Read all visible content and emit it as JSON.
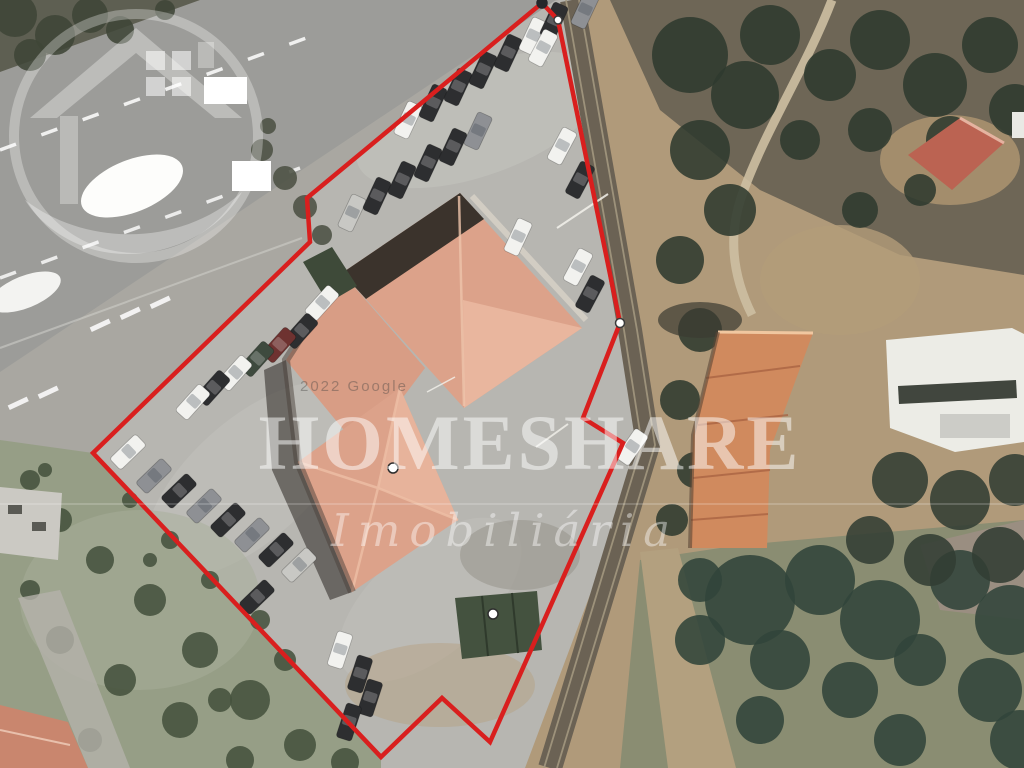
{
  "meta": {
    "description": "Aerial satellite photo of a property with red boundary outline"
  },
  "watermark": {
    "brand": "HOMESHARE",
    "tagline": "Imobiliária",
    "attribution": "2022 Google",
    "text_color": "#ffffff"
  },
  "boundary": {
    "color": "#d91f1e",
    "stroke_width": 4.5,
    "vertices": [
      [
        542,
        3
      ],
      [
        558,
        20
      ],
      [
        620,
        323
      ],
      [
        583,
        418
      ],
      [
        623,
        443
      ],
      [
        490,
        742
      ],
      [
        442,
        698
      ],
      [
        381,
        757
      ],
      [
        93,
        453
      ],
      [
        310,
        242
      ],
      [
        307,
        198
      ]
    ],
    "markers": [
      {
        "x": 542,
        "y": 3,
        "r": 5,
        "fill": "#26262a",
        "ring": "#26262a"
      },
      {
        "x": 558,
        "y": 20,
        "r": 4,
        "fill": "#ffffff",
        "ring": "#3c3c3c"
      },
      {
        "x": 620,
        "y": 323,
        "r": 4.5,
        "fill": "#ffffff",
        "ring": "#3c3c3c"
      },
      {
        "x": 393,
        "y": 468,
        "r": 5,
        "fill": "#ffffff",
        "ring": "#2e2e2e"
      },
      {
        "x": 493,
        "y": 614,
        "r": 5,
        "fill": "#ffffff",
        "ring": "#2e2e2e"
      }
    ]
  },
  "scene": {
    "palette": {
      "parking": "#b7b6b1",
      "road": "#9c9c99",
      "median": "#a9a7a1",
      "field": "#969e86",
      "dirt_tan": "#b09a7a",
      "terrain_brown": "#6e6656",
      "rail_band": "#6b6254",
      "roof_main": "#dca28a",
      "roof_main_light": "#e9b69e",
      "roof_shadow": "#3b332c",
      "roof_right": "#d08a5e",
      "green_canopy": "#3e4a39",
      "bottom_green": "#8a8d72",
      "marking_white": "#ffffff"
    },
    "cars": [
      [
        408,
        120,
        -65,
        "#f2f2ef"
      ],
      [
        433,
        103,
        -65,
        "#2d2e30"
      ],
      [
        458,
        87,
        -65,
        "#2d2e30"
      ],
      [
        483,
        70,
        -65,
        "#2d2e30"
      ],
      [
        508,
        53,
        -65,
        "#2d2e30"
      ],
      [
        533,
        36,
        -65,
        "#f2f2ef"
      ],
      [
        554,
        21,
        -65,
        "#2d2e30"
      ],
      [
        352,
        213,
        -65,
        "#c8c8c4"
      ],
      [
        377,
        196,
        -65,
        "#2d2e30"
      ],
      [
        402,
        180,
        -65,
        "#2d2e30"
      ],
      [
        428,
        163,
        -65,
        "#2d2e30"
      ],
      [
        453,
        147,
        -65,
        "#2d2e30"
      ],
      [
        478,
        131,
        -65,
        "#8e9094"
      ],
      [
        518,
        237,
        -65,
        "#f2f2ef"
      ],
      [
        543,
        48,
        -62,
        "#f2f2ef"
      ],
      [
        562,
        146,
        -62,
        "#f2f2ef"
      ],
      [
        580,
        180,
        -62,
        "#2d2e30"
      ],
      [
        578,
        267,
        -62,
        "#f2f2ef"
      ],
      [
        590,
        294,
        -62,
        "#2d2e30"
      ],
      [
        322,
        303,
        -48,
        "#f2f2ef"
      ],
      [
        301,
        331,
        -48,
        "#2d2e30"
      ],
      [
        279,
        345,
        -48,
        "#6e3230"
      ],
      [
        257,
        359,
        -48,
        "#3e4a3e"
      ],
      [
        235,
        373,
        -48,
        "#f2f2ef"
      ],
      [
        213,
        388,
        -48,
        "#2d2e30"
      ],
      [
        193,
        402,
        -48,
        "#f2f2ef"
      ],
      [
        128,
        452,
        -44,
        "#f2f2ef"
      ],
      [
        154,
        476,
        -44,
        "#8e9094"
      ],
      [
        179,
        491,
        -44,
        "#2d2e30"
      ],
      [
        204,
        506,
        -44,
        "#8e9094"
      ],
      [
        228,
        520,
        -44,
        "#2d2e30"
      ],
      [
        252,
        535,
        -44,
        "#8e9094"
      ],
      [
        276,
        550,
        -44,
        "#2d2e30"
      ],
      [
        299,
        565,
        -44,
        "#c8c8c4"
      ],
      [
        257,
        597,
        -44,
        "#2d2e30"
      ],
      [
        340,
        650,
        -72,
        "#f2f2ef"
      ],
      [
        360,
        674,
        -72,
        "#2d2e30"
      ],
      [
        370,
        698,
        -72,
        "#2d2e30"
      ],
      [
        349,
        722,
        -72,
        "#2d2e30"
      ],
      [
        632,
        447,
        -55,
        "#f2f2ef"
      ],
      [
        585,
        10,
        -65,
        "#8e9094"
      ]
    ],
    "trees": {
      "top_left_corner": {
        "color": "#3f4637",
        "items": [
          [
            15,
            15,
            22
          ],
          [
            55,
            35,
            20
          ],
          [
            90,
            15,
            18
          ],
          [
            30,
            55,
            16
          ],
          [
            120,
            30,
            14
          ],
          [
            165,
            10,
            10
          ]
        ]
      },
      "median_bushes": {
        "color": "#4c5143",
        "items": [
          [
            262,
            150,
            11
          ],
          [
            285,
            178,
            12
          ],
          [
            305,
            207,
            12
          ],
          [
            322,
            235,
            10
          ],
          [
            268,
            126,
            8
          ]
        ]
      },
      "right_strip": {
        "color": "#2f3a2f",
        "items": [
          [
            690,
            55,
            38
          ],
          [
            745,
            95,
            34
          ],
          [
            700,
            150,
            30
          ],
          [
            770,
            35,
            30
          ],
          [
            830,
            75,
            26
          ],
          [
            880,
            40,
            30
          ],
          [
            935,
            85,
            32
          ],
          [
            990,
            45,
            28
          ],
          [
            1015,
            110,
            26
          ],
          [
            950,
            140,
            24
          ],
          [
            870,
            130,
            22
          ],
          [
            800,
            140,
            20
          ],
          [
            730,
            210,
            26
          ],
          [
            680,
            260,
            24
          ],
          [
            700,
            330,
            22
          ],
          [
            680,
            400,
            20
          ],
          [
            695,
            470,
            18
          ],
          [
            860,
            210,
            18
          ],
          [
            920,
            190,
            16
          ],
          [
            672,
            520,
            16
          ]
        ]
      },
      "below_white_structure": {
        "color": "#323d33",
        "items": [
          [
            900,
            480,
            28
          ],
          [
            960,
            500,
            30
          ],
          [
            1015,
            480,
            26
          ],
          [
            870,
            540,
            24
          ],
          [
            930,
            560,
            26
          ],
          [
            1000,
            555,
            28
          ]
        ]
      },
      "bottom_right": {
        "color": "#31443a",
        "items": [
          [
            750,
            600,
            45
          ],
          [
            820,
            580,
            35
          ],
          [
            880,
            620,
            40
          ],
          [
            960,
            580,
            30
          ],
          [
            1010,
            620,
            35
          ],
          [
            780,
            660,
            30
          ],
          [
            700,
            640,
            25
          ],
          [
            850,
            690,
            28
          ],
          [
            990,
            690,
            32
          ],
          [
            1020,
            740,
            30
          ],
          [
            920,
            660,
            26
          ],
          [
            700,
            580,
            22
          ],
          [
            760,
            720,
            24
          ],
          [
            900,
            740,
            26
          ]
        ]
      },
      "bottom_left_field": {
        "color": "#46523d",
        "items": [
          [
            30,
            480,
            10
          ],
          [
            60,
            520,
            12
          ],
          [
            100,
            560,
            14
          ],
          [
            150,
            600,
            16
          ],
          [
            200,
            650,
            18
          ],
          [
            250,
            700,
            20
          ],
          [
            120,
            680,
            16
          ],
          [
            60,
            640,
            14
          ],
          [
            180,
            720,
            18
          ],
          [
            90,
            740,
            12
          ],
          [
            30,
            590,
            10
          ],
          [
            240,
            760,
            14
          ],
          [
            45,
            470,
            7
          ],
          [
            130,
            500,
            8
          ],
          [
            170,
            540,
            9
          ],
          [
            210,
            580,
            9
          ],
          [
            260,
            620,
            10
          ],
          [
            285,
            660,
            11
          ],
          [
            150,
            560,
            7
          ],
          [
            220,
            700,
            12
          ],
          [
            300,
            745,
            16
          ],
          [
            345,
            762,
            14
          ]
        ]
      }
    }
  }
}
